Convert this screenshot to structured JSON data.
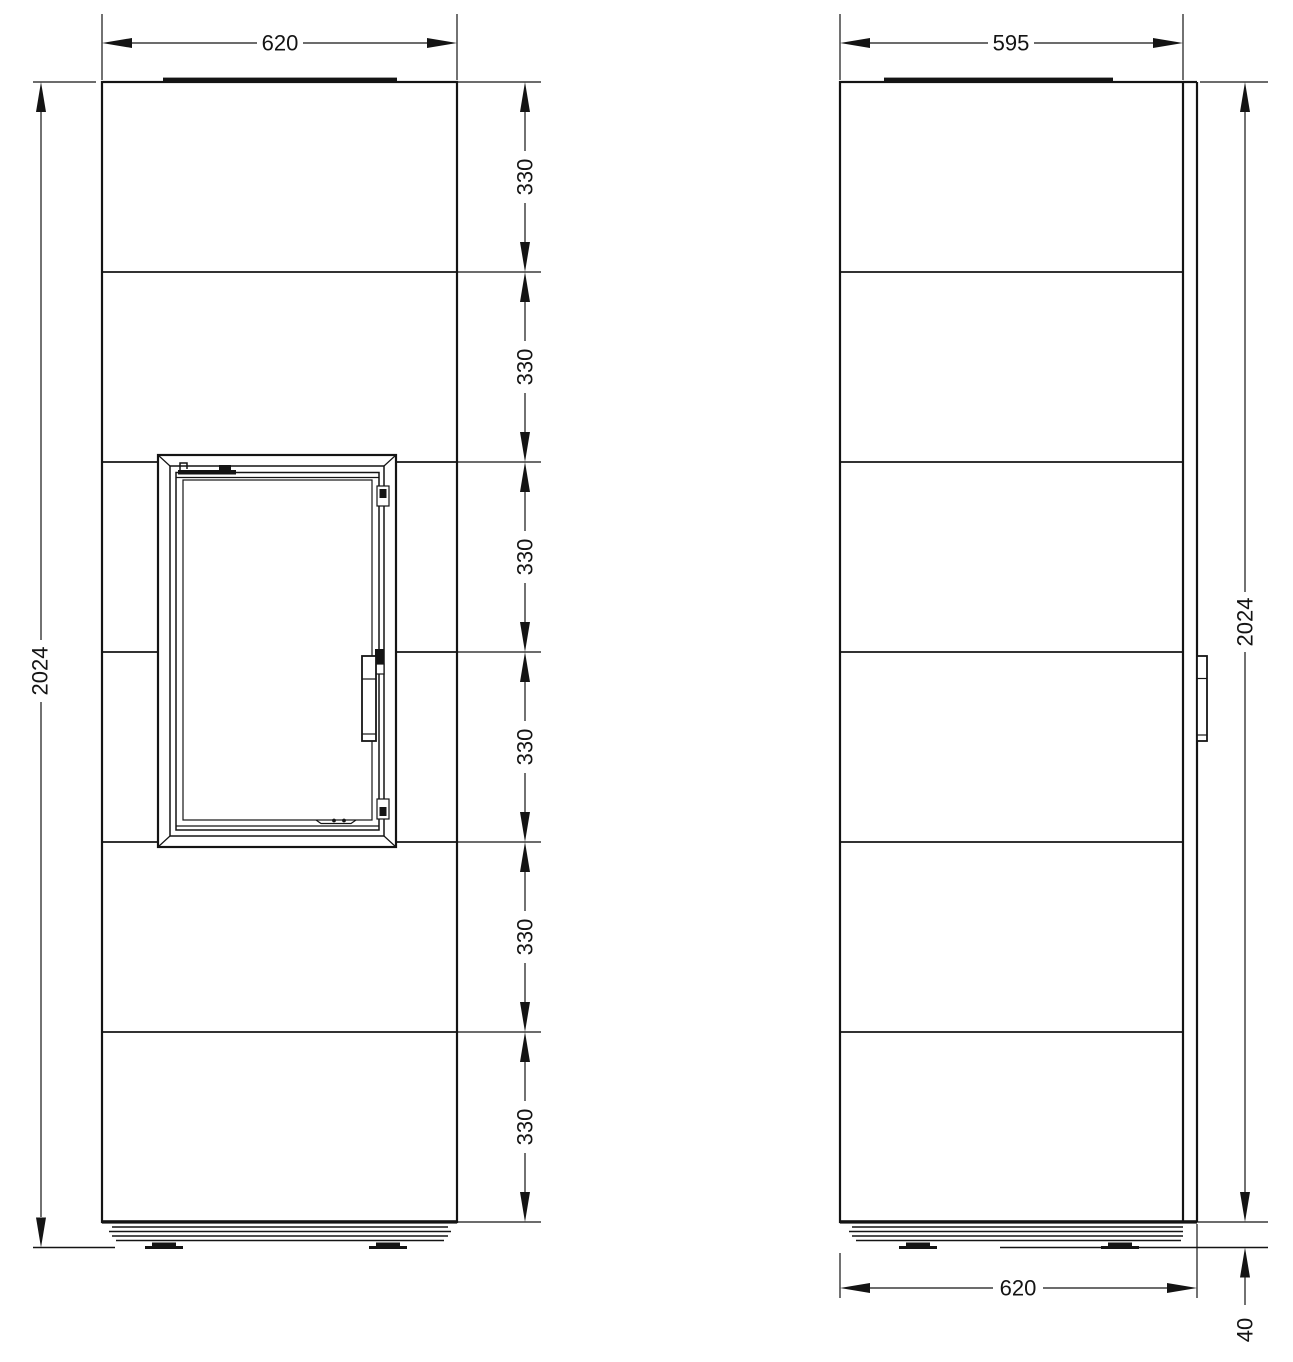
{
  "drawing": {
    "kind": "stove technical dimension drawing, front and side elevation"
  },
  "dimensions": {
    "front_width": "620",
    "depth": "595",
    "overall_height": "2024",
    "overall_depth_bottom": "620",
    "base_height": "40",
    "segment_labels": [
      "330",
      "330",
      "330",
      "330",
      "330",
      "330"
    ]
  },
  "colors": {
    "line": "#141414",
    "background": "#ffffff"
  }
}
